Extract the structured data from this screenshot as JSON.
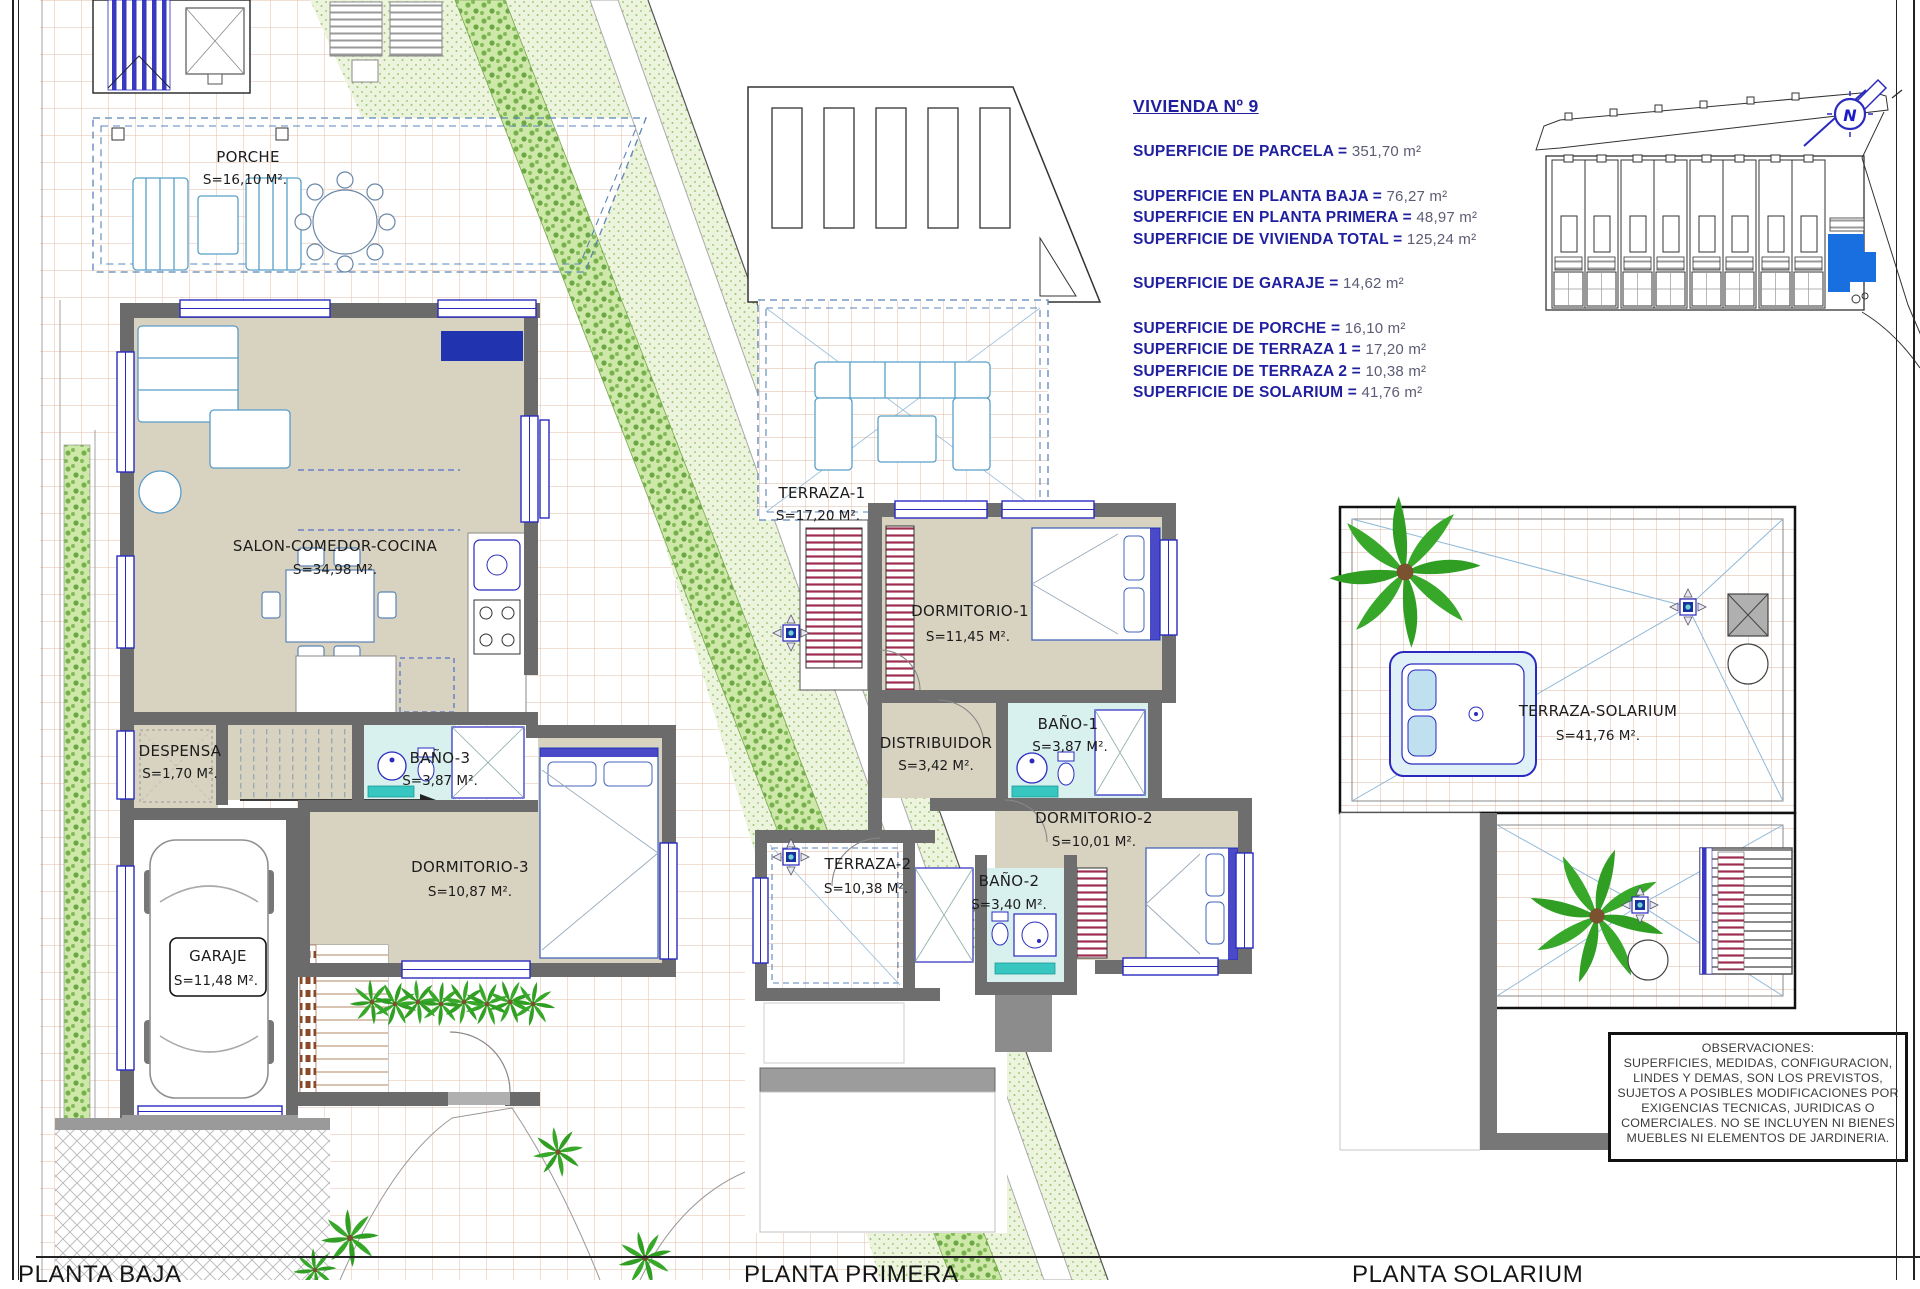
{
  "info_panel": {
    "title": "VIVIENDA Nº 9",
    "rows": [
      {
        "label": "SUPERFICIE DE PARCELA = ",
        "value": "351,70 m²"
      },
      {
        "label": "SUPERFICIE EN PLANTA BAJA = ",
        "value": "76,27 m²"
      },
      {
        "label": "SUPERFICIE EN PLANTA PRIMERA = ",
        "value": "48,97 m²"
      },
      {
        "label": "SUPERFICIE DE VIVIENDA TOTAL = ",
        "value": "125,24 m²"
      },
      {
        "label": "SUPERFICIE DE GARAJE = ",
        "value": "14,62 m²"
      },
      {
        "label": "SUPERFICIE DE PORCHE = ",
        "value": "16,10 m²"
      },
      {
        "label": "SUPERFICIE DE TERRAZA 1 = ",
        "value": "17,20 m²"
      },
      {
        "label": "SUPERFICIE DE TERRAZA 2 = ",
        "value": "10,38 m²"
      },
      {
        "label": "SUPERFICIE DE SOLARIUM = ",
        "value": "41,76 m²"
      }
    ]
  },
  "plans": {
    "baja": {
      "title": "PLANTA BAJA",
      "rooms": {
        "porche": {
          "name": "PORCHE",
          "area": "S=16,10 M²."
        },
        "salon": {
          "name": "SALON-COMEDOR-COCINA",
          "area": "S=34,98 M²."
        },
        "despensa": {
          "name": "DESPENSA",
          "area": "S=1,70 M²."
        },
        "bano3": {
          "name": "BAÑO-3",
          "area": "S=3,87 M²."
        },
        "dorm3": {
          "name": "DORMITORIO-3",
          "area": "S=10,87 M²."
        },
        "garaje": {
          "name": "GARAJE",
          "area": "S=11,48 M²."
        }
      }
    },
    "primera": {
      "title": "PLANTA PRIMERA",
      "rooms": {
        "terraza1": {
          "name": "TERRAZA-1",
          "area": "S=17,20 M²."
        },
        "dorm1": {
          "name": "DORMITORIO-1",
          "area": "S=11,45 M²."
        },
        "distribuidor": {
          "name": "DISTRIBUIDOR",
          "area": "S=3,42 M²."
        },
        "bano1": {
          "name": "BAÑO-1",
          "area": "S=3,87 M²."
        },
        "dorm2": {
          "name": "DORMITORIO-2",
          "area": "S=10,01 M²."
        },
        "terraza2": {
          "name": "TERRAZA-2",
          "area": "S=10,38 M²."
        },
        "bano2": {
          "name": "BAÑO-2",
          "area": "S=3,40 M²."
        }
      }
    },
    "solarium": {
      "title": "PLANTA SOLARIUM",
      "rooms": {
        "terraza_solarium": {
          "name": "TERRAZA-SOLARIUM",
          "area": "S=41,76 M²."
        }
      }
    }
  },
  "site_plan": {
    "north_label": "N"
  },
  "observaciones": {
    "title": "OBSERVACIONES:",
    "lines": [
      "SUPERFICIES, MEDIDAS, CONFIGURACION,",
      "LINDES Y DEMAS, SON LOS PREVISTOS,",
      "SUJETOS A POSIBLES MODIFICACIONES POR",
      "EXIGENCIAS TECNICAS, JURIDICAS O",
      "COMERCIALES. NO SE INCLUYEN NI BIENES",
      "MUEBLES NI ELEMENTOS DE JARDINERIA."
    ]
  }
}
